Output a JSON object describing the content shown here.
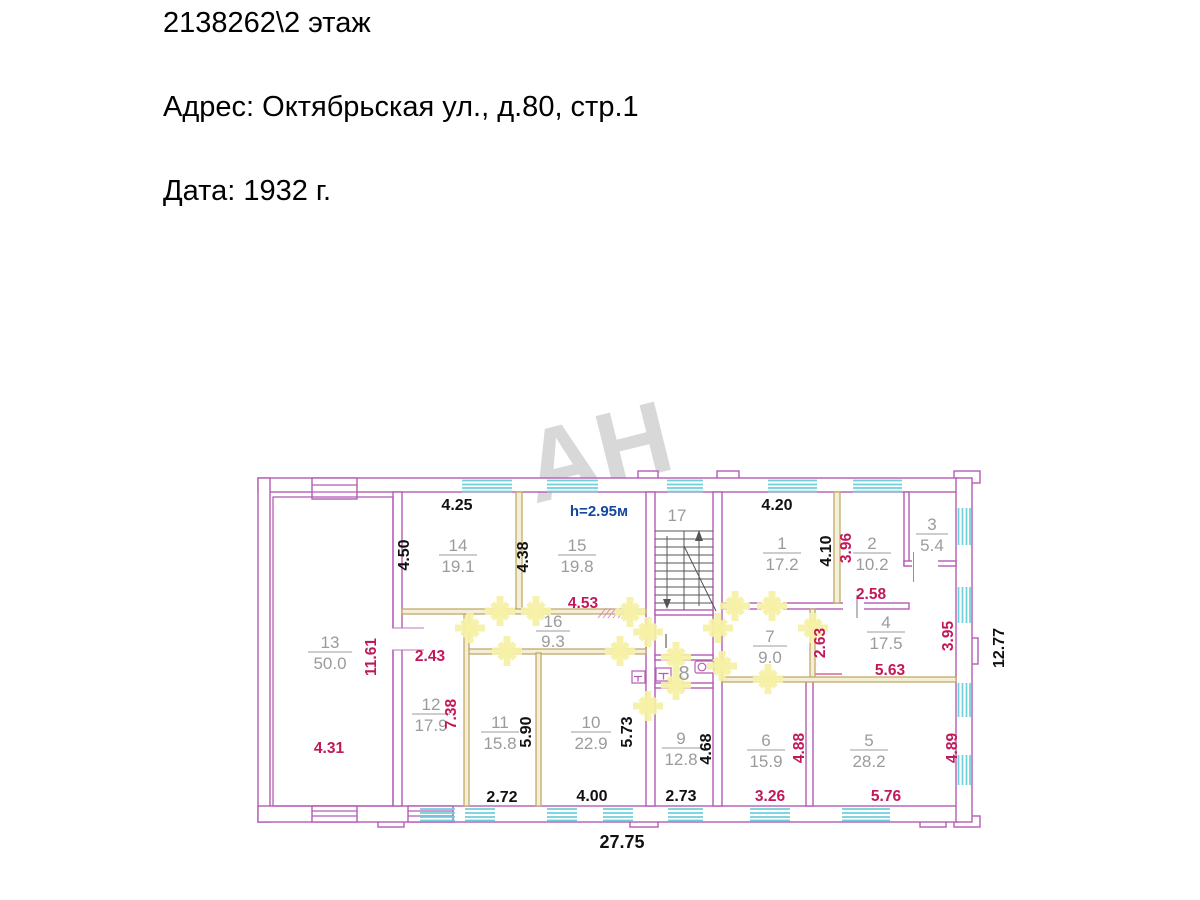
{
  "header": {
    "line1": "2138262\\2 этаж",
    "line2": "Адрес: Октябрьская ул., д.80, стр.1",
    "line3": "Дата: 1932 г."
  },
  "watermark": {
    "text": "АН"
  },
  "plan": {
    "ceiling_height": "h=2.95м",
    "stairwell": {
      "number": "17"
    },
    "hall": {
      "label": "I"
    },
    "wc": {
      "number": "8"
    },
    "rooms": [
      {
        "number": "1",
        "area": "17.2"
      },
      {
        "number": "2",
        "area": "10.2"
      },
      {
        "number": "3",
        "area": "5.4"
      },
      {
        "number": "4",
        "area": "17.5"
      },
      {
        "number": "5",
        "area": "28.2"
      },
      {
        "number": "6",
        "area": "15.9"
      },
      {
        "number": "7",
        "area": "9.0"
      },
      {
        "number": "9",
        "area": "12.8"
      },
      {
        "number": "10",
        "area": "22.9"
      },
      {
        "number": "11",
        "area": "15.8"
      },
      {
        "number": "12",
        "area": "17.9"
      },
      {
        "number": "13",
        "area": "50.0"
      },
      {
        "number": "14",
        "area": "19.1"
      },
      {
        "number": "15",
        "area": "19.8"
      },
      {
        "number": "16",
        "area": "9.3"
      }
    ],
    "dims_black": {
      "room14_w": "4.25",
      "room14_h": "4.50",
      "room15_h": "4.38",
      "room1_w": "4.20",
      "room1_h": "4.10",
      "room11_h": "5.90",
      "room10_h": "5.73",
      "room9_h": "4.68",
      "room11_w": "2.72",
      "room10_w": "4.00",
      "room9_w": "2.73",
      "overall_w": "27.75",
      "overall_d": "12.77"
    },
    "dims_red": {
      "corridor_w": "4.53",
      "room12_w": "2.43",
      "room13_h": "11.61",
      "room12_h": "7.38",
      "room13_w": "4.31",
      "room2_h": "3.96",
      "room2_w": "2.58",
      "room4_hl": "2.63",
      "room4_w": "5.63",
      "room4_hr": "3.95",
      "room6_h": "4.88",
      "room5_h": "4.89",
      "room6_w": "3.26",
      "room5_w": "5.76"
    }
  },
  "colors": {
    "wall": "#b45cb4",
    "partition": "#bfa35e",
    "window": "#6fd0da",
    "door_mark": "#f5f1a4",
    "dim_black": "#111111",
    "dim_red": "#c2185b",
    "height_blue": "#16479e",
    "room_label": "#9b9b9b"
  }
}
